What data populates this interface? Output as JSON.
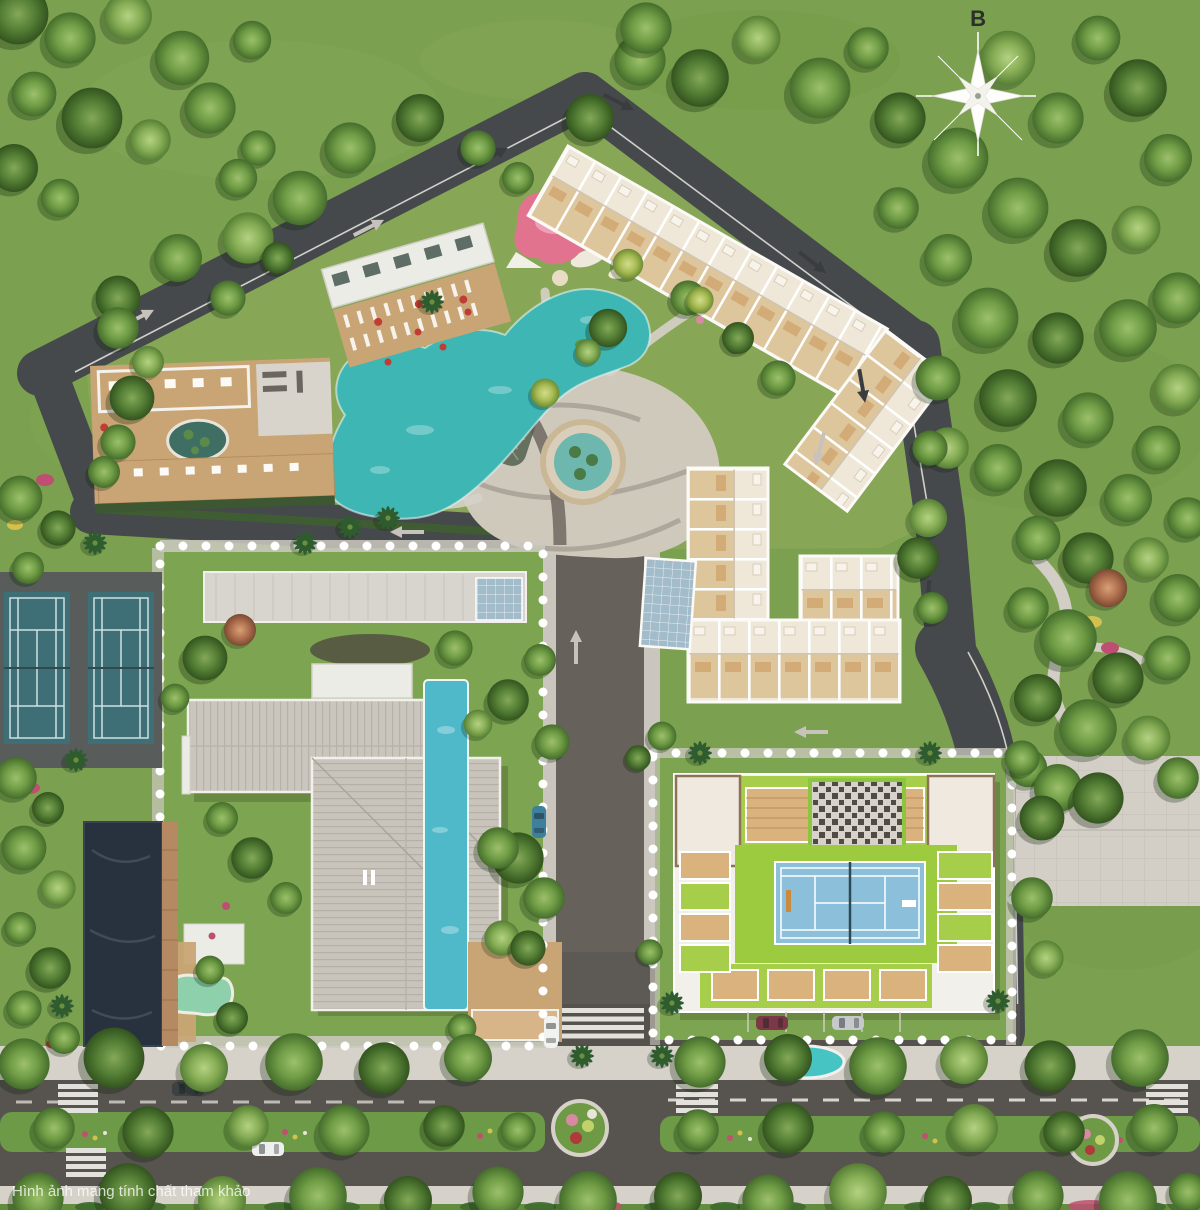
{
  "compass": {
    "label": "B"
  },
  "watermark": {
    "text": "Hình ảnh mang tính chất tham khảo"
  },
  "colors": {
    "lawn": "#7ba150",
    "campus_lawn": "#87a757",
    "asphalt": "#46494b",
    "road_center": "#66615b",
    "paving": "#d2cec6",
    "pool": "#3db6b4",
    "lap_pool": "#4fb9c9",
    "oval_pool": "#46c4c4",
    "pond": "#28323e",
    "tennis_ground_court": "#3e6f76",
    "tennis_ground_apron": "#585c5a",
    "rooftop_court": "#8cc0da",
    "rooftop_apron": "#9ccb3f",
    "floorplan": "#e2cfa5",
    "roof": "#c9c4bb",
    "wood": "#c9a575",
    "playground": "#e2738f",
    "boundary_dots": "#ffffff",
    "median_green": "#6d9a46"
  }
}
